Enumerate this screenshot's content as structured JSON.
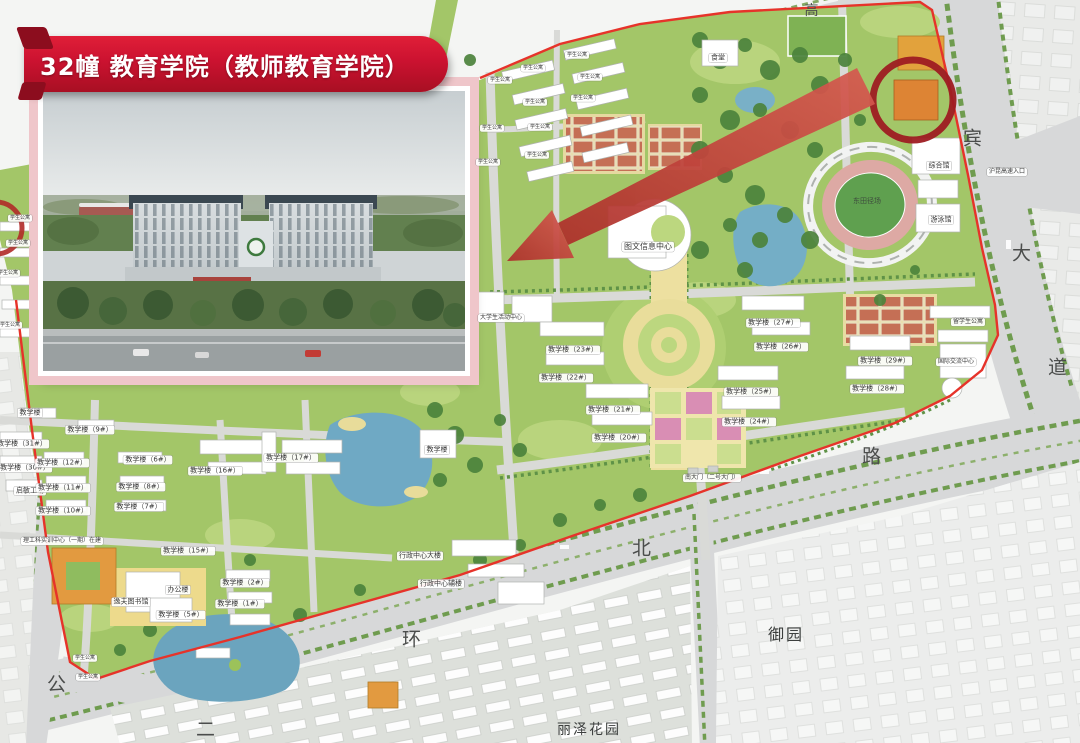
{
  "banner": {
    "title": "32幢 教育学院（教师教育学院）"
  },
  "colors": {
    "banner_red": "#CB1230",
    "banner_dark": "#8C0D1E",
    "boundary": "#E6332A",
    "arrow": "#C0392F",
    "circle": "#9E1C22"
  },
  "map": {
    "labels": [
      {
        "t": "图文信息中心",
        "x": 648,
        "y": 247,
        "c": "box",
        "s": 8
      },
      {
        "t": "综合馆",
        "x": 939,
        "y": 166,
        "c": "box"
      },
      {
        "t": "游泳馆",
        "x": 941,
        "y": 220,
        "c": "box"
      },
      {
        "t": "东田径场",
        "x": 867,
        "y": 201,
        "c": "plain"
      },
      {
        "t": "沪昆高速入口",
        "x": 1007,
        "y": 172,
        "c": "box",
        "s": 6
      },
      {
        "t": "留学生公寓",
        "x": 968,
        "y": 322,
        "c": "box",
        "s": 6
      },
      {
        "t": "国际交流中心",
        "x": 956,
        "y": 362,
        "c": "box",
        "s": 6
      },
      {
        "t": "教学楼（29#）",
        "x": 885,
        "y": 361,
        "c": "box"
      },
      {
        "t": "教学楼（28#）",
        "x": 877,
        "y": 389,
        "c": "box"
      },
      {
        "t": "教学楼（27#）",
        "x": 773,
        "y": 323,
        "c": "box"
      },
      {
        "t": "教学楼（26#）",
        "x": 781,
        "y": 347,
        "c": "box"
      },
      {
        "t": "教学楼（25#）",
        "x": 751,
        "y": 392,
        "c": "box"
      },
      {
        "t": "教学楼（24#）",
        "x": 749,
        "y": 422,
        "c": "box"
      },
      {
        "t": "教学楼（23#）",
        "x": 573,
        "y": 350,
        "c": "box"
      },
      {
        "t": "教学楼（22#）",
        "x": 566,
        "y": 378,
        "c": "box"
      },
      {
        "t": "教学楼（21#）",
        "x": 613,
        "y": 410,
        "c": "box"
      },
      {
        "t": "教学楼（20#）",
        "x": 619,
        "y": 438,
        "c": "box"
      },
      {
        "t": "大学生活动中心",
        "x": 501,
        "y": 318,
        "c": "box",
        "s": 6
      },
      {
        "t": "南大门（二号大门）",
        "x": 712,
        "y": 478,
        "c": "box",
        "s": 6
      },
      {
        "t": "行政中心大楼",
        "x": 420,
        "y": 556,
        "c": "box"
      },
      {
        "t": "行政中心辅楼",
        "x": 441,
        "y": 584,
        "c": "box"
      },
      {
        "t": "教学楼",
        "x": 437,
        "y": 450,
        "c": "box"
      },
      {
        "t": "教学楼（17#）",
        "x": 291,
        "y": 458,
        "c": "box"
      },
      {
        "t": "教学楼（16#）",
        "x": 215,
        "y": 471,
        "c": "box"
      },
      {
        "t": "教学楼（15#）",
        "x": 188,
        "y": 551,
        "c": "box"
      },
      {
        "t": "教学楼（31#）",
        "x": 22,
        "y": 444,
        "c": "box"
      },
      {
        "t": "教学楼（30#）",
        "x": 25,
        "y": 468,
        "c": "box"
      },
      {
        "t": "启敏工场",
        "x": 30,
        "y": 491,
        "c": "box"
      },
      {
        "t": "教学楼",
        "x": 30,
        "y": 413,
        "c": "box"
      },
      {
        "t": "教学楼（9#）",
        "x": 90,
        "y": 430,
        "c": "box"
      },
      {
        "t": "教学楼（12#）",
        "x": 62,
        "y": 463,
        "c": "box"
      },
      {
        "t": "教学楼（11#）",
        "x": 63,
        "y": 488,
        "c": "box"
      },
      {
        "t": "教学楼（10#）",
        "x": 63,
        "y": 511,
        "c": "box"
      },
      {
        "t": "教学楼（8#）",
        "x": 141,
        "y": 487,
        "c": "box"
      },
      {
        "t": "教学楼（7#）",
        "x": 139,
        "y": 507,
        "c": "box"
      },
      {
        "t": "教学楼（6#）",
        "x": 148,
        "y": 460,
        "c": "box"
      },
      {
        "t": "理工科实训中心（一期）在建",
        "x": 62,
        "y": 541,
        "c": "box",
        "s": 6
      },
      {
        "t": "逸夫图书馆",
        "x": 131,
        "y": 602,
        "c": "box"
      },
      {
        "t": "办公楼",
        "x": 178,
        "y": 590,
        "c": "box"
      },
      {
        "t": "教学楼（2#）",
        "x": 245,
        "y": 583,
        "c": "box"
      },
      {
        "t": "教学楼（1#）",
        "x": 240,
        "y": 604,
        "c": "box"
      },
      {
        "t": "教学楼（5#）",
        "x": 181,
        "y": 615,
        "c": "box"
      },
      {
        "t": "食堂",
        "x": 718,
        "y": 58,
        "c": "box"
      },
      {
        "t": "学生公寓",
        "x": 533,
        "y": 68,
        "c": "box",
        "s": 5
      },
      {
        "t": "学生公寓",
        "x": 577,
        "y": 55,
        "c": "box",
        "s": 5
      },
      {
        "t": "学生公寓",
        "x": 500,
        "y": 80,
        "c": "box",
        "s": 5
      },
      {
        "t": "学生公寓",
        "x": 590,
        "y": 77,
        "c": "box",
        "s": 5
      },
      {
        "t": "学生公寓",
        "x": 535,
        "y": 102,
        "c": "box",
        "s": 5
      },
      {
        "t": "学生公寓",
        "x": 583,
        "y": 98,
        "c": "box",
        "s": 5
      },
      {
        "t": "学生公寓",
        "x": 492,
        "y": 128,
        "c": "box",
        "s": 5
      },
      {
        "t": "学生公寓",
        "x": 540,
        "y": 127,
        "c": "box",
        "s": 5
      },
      {
        "t": "学生公寓",
        "x": 537,
        "y": 155,
        "c": "box",
        "s": 5
      },
      {
        "t": "学生公寓",
        "x": 488,
        "y": 162,
        "c": "box",
        "s": 5
      },
      {
        "t": "学生公寓",
        "x": 20,
        "y": 218,
        "c": "box",
        "s": 5
      },
      {
        "t": "学生公寓",
        "x": 18,
        "y": 243,
        "c": "box",
        "s": 5
      },
      {
        "t": "学生公寓",
        "x": 8,
        "y": 273,
        "c": "box",
        "s": 5
      },
      {
        "t": "学生公寓",
        "x": 10,
        "y": 325,
        "c": "box",
        "s": 5
      },
      {
        "t": "学生公寓",
        "x": 85,
        "y": 658,
        "c": "box",
        "s": 5
      },
      {
        "t": "学生公寓",
        "x": 88,
        "y": 677,
        "c": "box",
        "s": 5
      },
      {
        "t": "高",
        "x": 812,
        "y": 10,
        "c": "road",
        "s": 14
      },
      {
        "t": "宾",
        "x": 973,
        "y": 137,
        "c": "road"
      },
      {
        "t": "大",
        "x": 1022,
        "y": 252,
        "c": "road"
      },
      {
        "t": "道",
        "x": 1058,
        "y": 366,
        "c": "road"
      },
      {
        "t": "路",
        "x": 872,
        "y": 455,
        "c": "road"
      },
      {
        "t": "北",
        "x": 642,
        "y": 547,
        "c": "road"
      },
      {
        "t": "环",
        "x": 412,
        "y": 638,
        "c": "road"
      },
      {
        "t": "公",
        "x": 57,
        "y": 683,
        "c": "road"
      },
      {
        "t": "二",
        "x": 206,
        "y": 728,
        "c": "road"
      },
      {
        "t": "御园",
        "x": 786,
        "y": 633,
        "c": "area"
      },
      {
        "t": "丽泽花园",
        "x": 589,
        "y": 729,
        "c": "area",
        "s": 14
      }
    ]
  }
}
